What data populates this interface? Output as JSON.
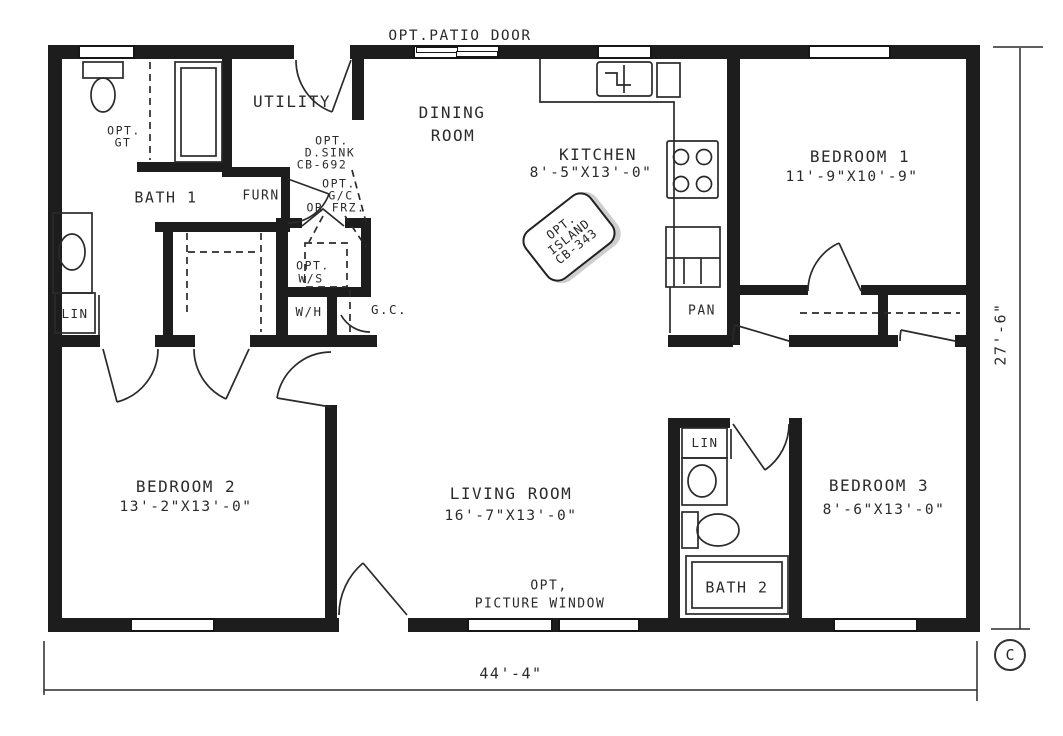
{
  "plan": {
    "title_note": "OPT.PATIO DOOR",
    "colors": {
      "ink": "#1d1d1d",
      "paper": "#ffffff"
    },
    "rooms": {
      "dining": {
        "lines": [
          "DINING",
          "ROOM"
        ]
      },
      "utility": {
        "name": "UTILITY"
      },
      "kitchen": {
        "name": "KITCHEN",
        "dims": "8'-5\"X13'-0\""
      },
      "bedroom1": {
        "name": "BEDROOM 1",
        "dims": "11'-9\"X10'-9\""
      },
      "bedroom2": {
        "name": "BEDROOM 2",
        "dims": "13'-2\"X13'-0\""
      },
      "bedroom3": {
        "name": "BEDROOM 3",
        "dims": "8'-6\"X13'-0\""
      },
      "living": {
        "name": "LIVING ROOM",
        "dims": "16'-7\"X13'-0\""
      },
      "bath1": {
        "name": "BATH 1"
      },
      "bath2": {
        "name": "BATH 2"
      },
      "pan": {
        "name": "PAN"
      },
      "furn": {
        "name": "FURN"
      },
      "wh": {
        "name": "W/H"
      },
      "gc_door": {
        "name": "G.C."
      },
      "lin_hall": {
        "name": "LIN"
      },
      "lin_bath2": {
        "name": "LIN"
      }
    },
    "options": {
      "patio_door": "OPT.PATIO DOOR",
      "gt": [
        "OPT.",
        "GT"
      ],
      "d_sink": [
        "OPT.",
        "D.SINK",
        "CB-692"
      ],
      "gc_frz": [
        "OPT.",
        "G/C",
        "OR FRZ."
      ],
      "ws": [
        "OPT.",
        "W/S"
      ],
      "island": [
        "OPT.",
        "ISLAND",
        "CB-343"
      ],
      "picture_window": [
        "OPT,",
        "PICTURE WINDOW"
      ]
    },
    "dimensions": {
      "overall_width": "44'-4\"",
      "overall_depth": "27'-6\""
    },
    "copyright_mark": "C"
  }
}
